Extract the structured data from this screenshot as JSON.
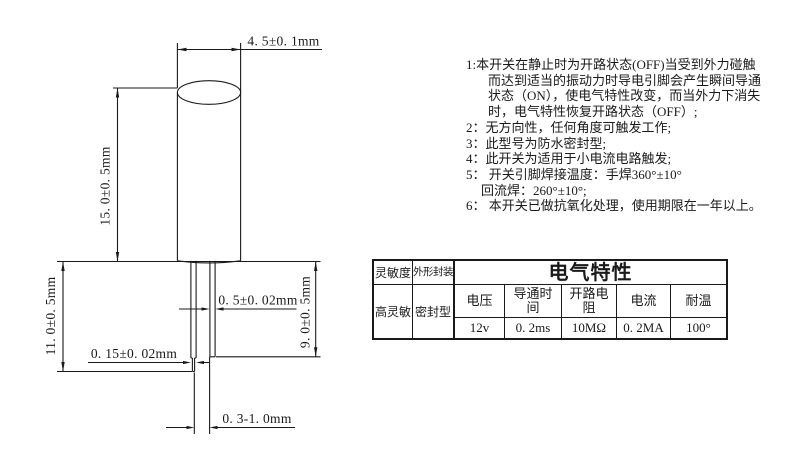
{
  "drawing": {
    "dim_top_diameter": "4. 5±0. 1mm",
    "dim_body_length": "15. 0±0. 5mm",
    "dim_left_pin": "11. 0±0. 5mm",
    "dim_right_pin": "9. 0±0. 5mm",
    "dim_pin_width": "0. 5±0. 02mm",
    "dim_tip_width": "0. 15±0. 02mm",
    "dim_pin_gap": "0. 3-1. 0mm"
  },
  "notes": {
    "lines": [
      "1:本开关在静止时为开路状态(OFF)当受到外力碰触",
      "而达到适当的振动力时导电引脚会产生瞬间导通",
      "状态（ON），使电气特性改变，而当外力下消失",
      "时，电气特性恢复开路状态（OFF）;",
      "2：无方向性，任何角度可触发工作;",
      "3：此型号为防水密封型;",
      "4：此开关为适用于小电流电路触发;",
      "5： 开关引脚焊接温度：手焊360°±10°",
      "回流焊：260°±10°;",
      "6： 本开关已做抗氧化处理，使用期限在一年以上。"
    ]
  },
  "table": {
    "sensitivity_header": "灵敏度",
    "package_header": "外形封装",
    "title": "电气特性",
    "sensitivity_value": "高灵敏",
    "package_value": "密封型",
    "spec_headers": [
      "电压",
      "导通时\n间",
      "开路电\n阻",
      "电流",
      "耐温"
    ],
    "spec_values": [
      "12v",
      "0. 2ms",
      "10MΩ",
      "0. 2MA",
      "100°"
    ]
  },
  "colors": {
    "ink": "#1a1a1a",
    "background": "#ffffff"
  }
}
